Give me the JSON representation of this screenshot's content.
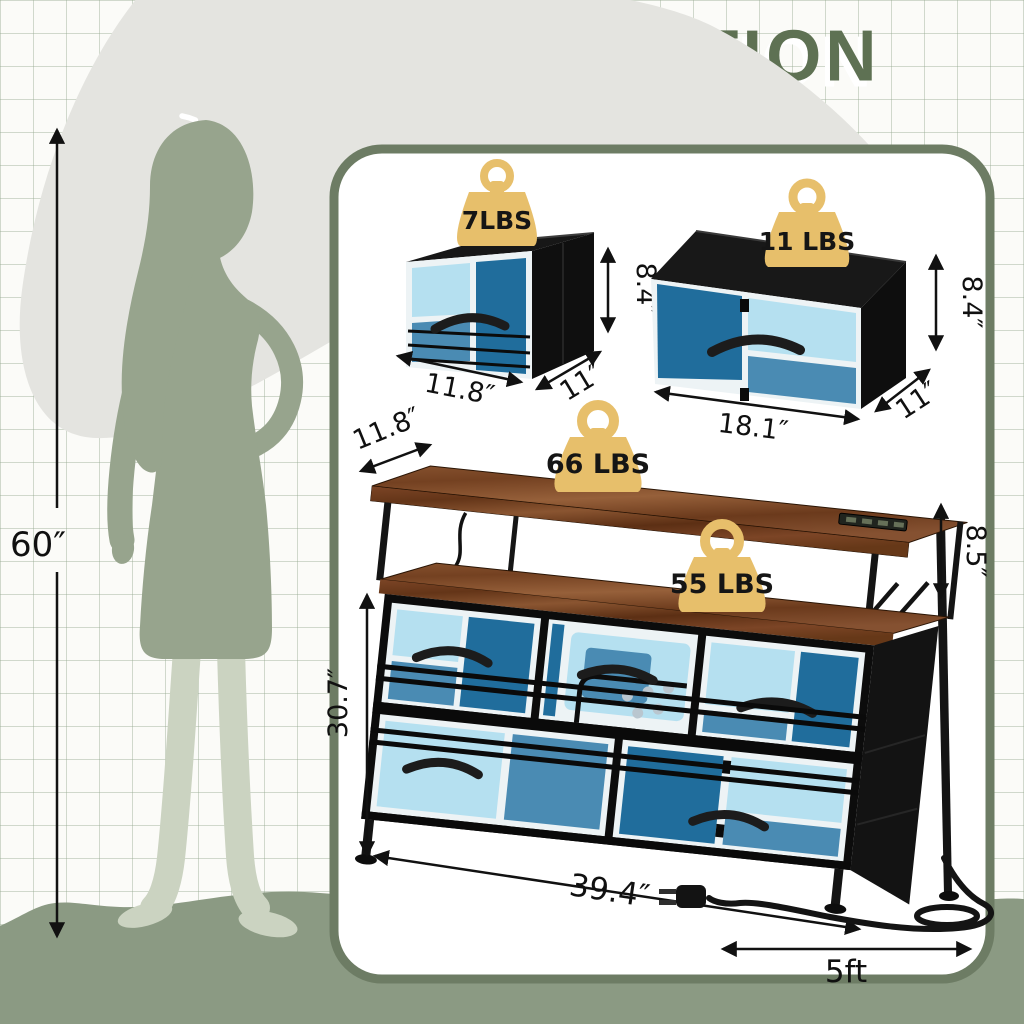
{
  "title": "SIZE INFORMATION",
  "person": {
    "height": "60″"
  },
  "bins": [
    {
      "weight_capacity": "7LBS",
      "height": "8.4″",
      "width": "11.8″",
      "depth": "11″"
    },
    {
      "weight_capacity": "11 LBS",
      "height": "8.4″",
      "width": "18.1″",
      "depth": "11″"
    }
  ],
  "dresser": {
    "top_weight_capacity": "66 LBS",
    "shelf_weight_capacity": "55 LBS",
    "depth": "11.8″",
    "shelf_clearance": "8.5″",
    "height": "30.7″",
    "width": "39.4″",
    "power_cord_length": "5ft"
  },
  "icons": {
    "weight": "kettlebell-weight-icon",
    "plug": "power-plug-icon",
    "arrow": "dimension-arrow"
  },
  "colors": {
    "title_green": "#5e7153",
    "panel_border": "#6d7c64",
    "weight_gold": "#e7bf6b",
    "fabric_light": "#b5e0f0",
    "fabric_mid": "#4a8bb3",
    "fabric_deep": "#206d9c",
    "wood_brown": "#7a4627",
    "silhouette": "#97a48d",
    "silhouette_light": "#cbd3c1",
    "ground": "#8b9a83",
    "gray_shape": "#e4e4e0"
  }
}
